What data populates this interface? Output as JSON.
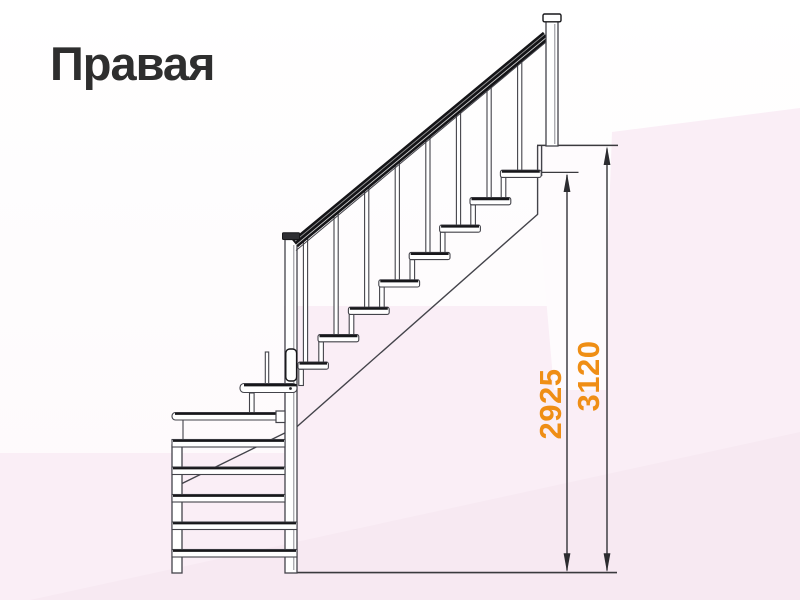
{
  "title": "Правая",
  "dimensions": [
    {
      "value": "2925"
    },
    {
      "value": "3120"
    }
  ],
  "structure": {
    "straight_flight_treads": 8,
    "winder_treads": 6,
    "balusters": 8,
    "newel_posts": 2
  },
  "colors": {
    "title_text": "#2e2e2e",
    "dimension_label": "#ef8e15",
    "dimension_line": "#333338",
    "line_main": "#43434a",
    "line_dark": "#17171a",
    "handrail": "#141417",
    "background": "#fefbfd",
    "background_pink": "#faeef6",
    "background_pink_deep": "#f7e9f2"
  }
}
